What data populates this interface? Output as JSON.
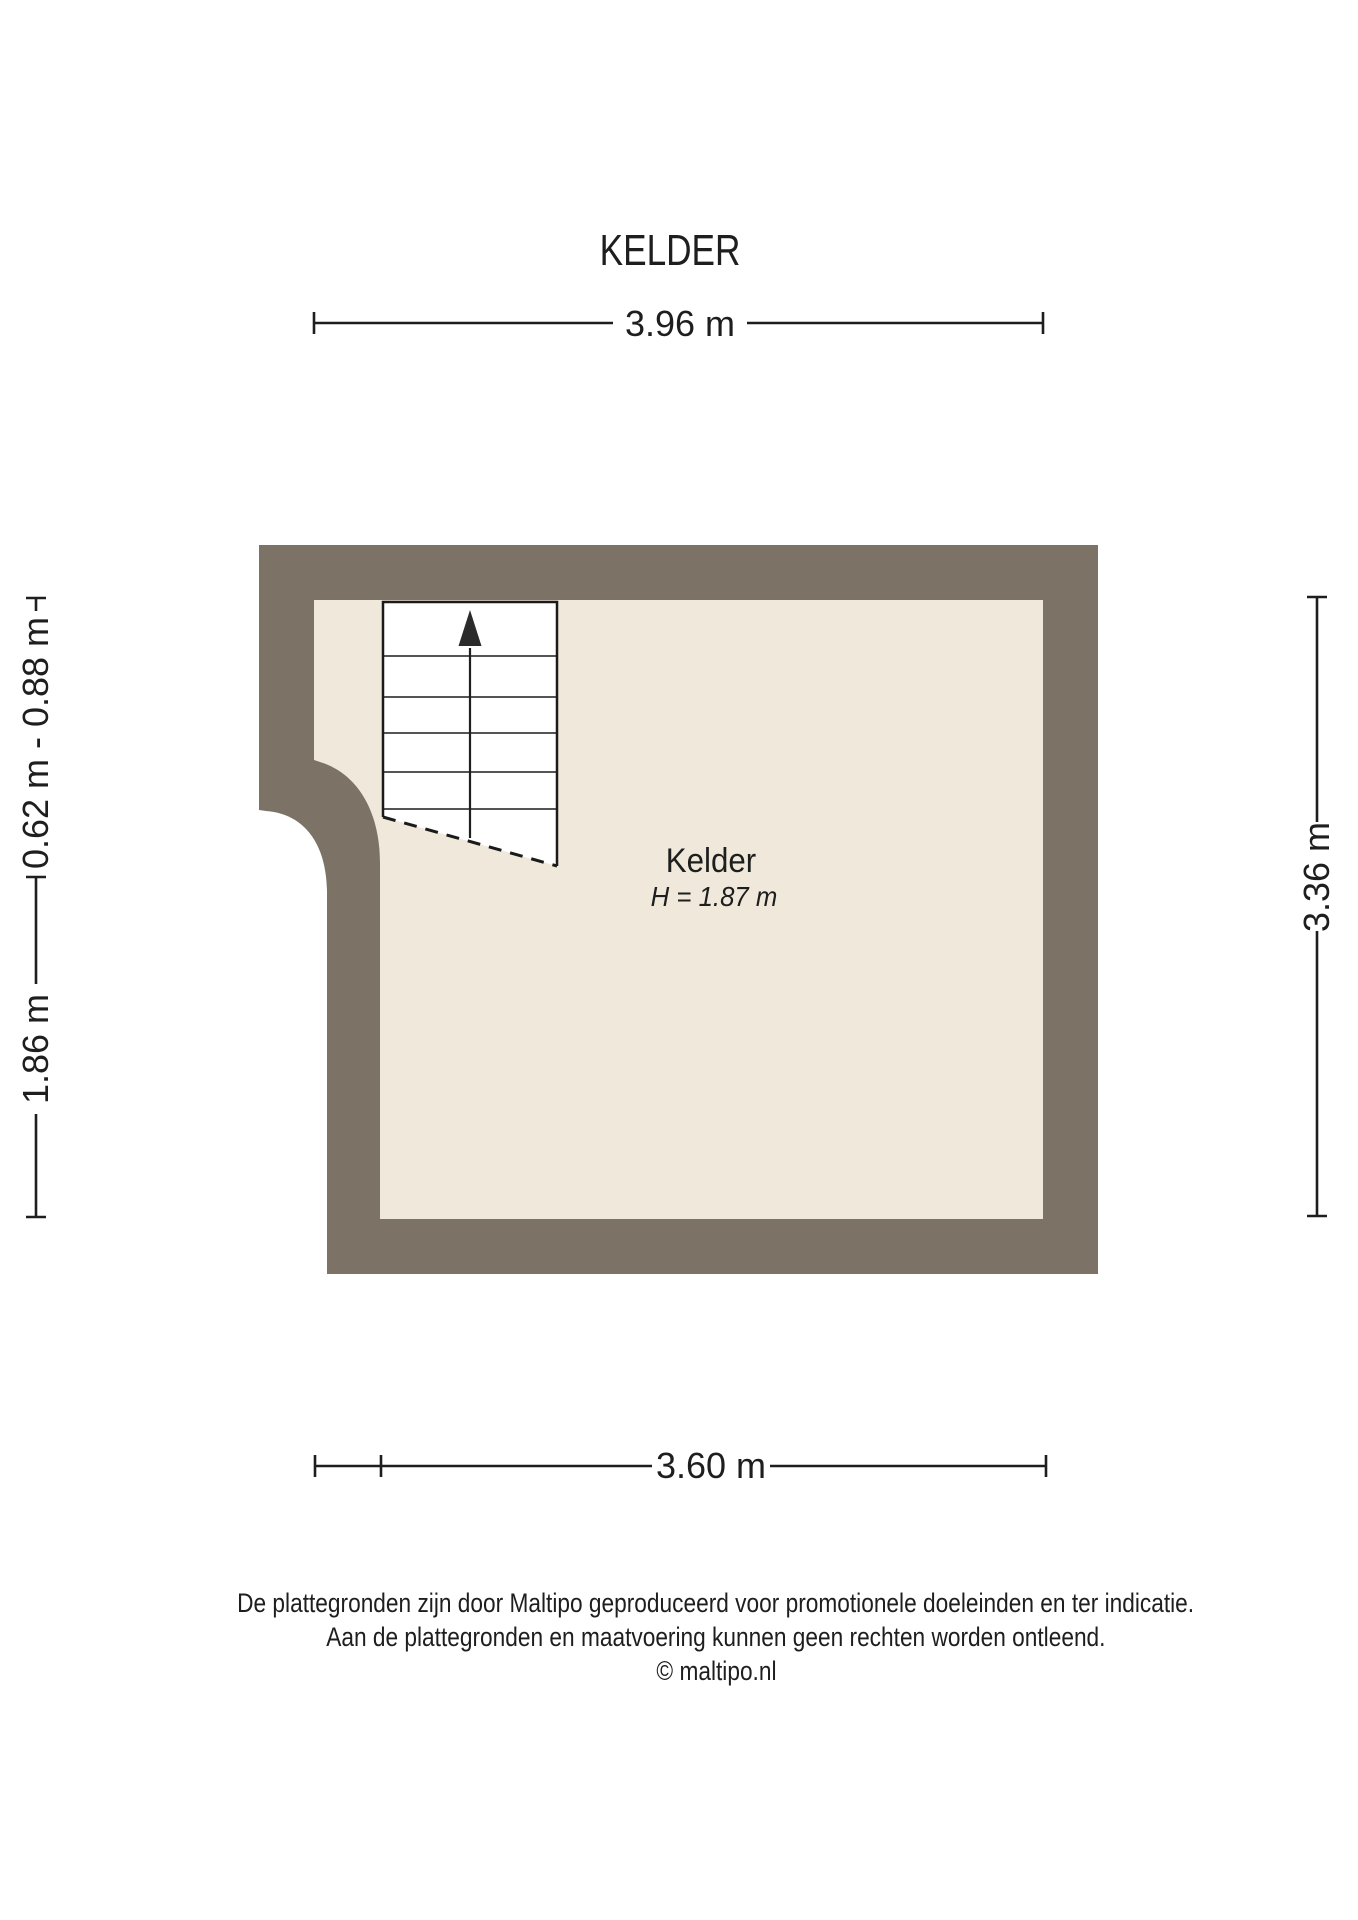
{
  "title": "KELDER",
  "room": {
    "name": "Kelder",
    "height": "H = 1.87 m"
  },
  "dimensions": {
    "top": "3.96 m",
    "left_upper": "0.62 m - 0.88 m",
    "left_lower": "1.86 m",
    "right": "3.36 m",
    "bottom": "3.60 m"
  },
  "footer": {
    "line1": "De plattegronden zijn door Maltipo geproduceerd voor promotionele doeleinden en ter indicatie.",
    "line2": "Aan de plattegronden en maatvoering kunnen geen rechten worden ontleend.",
    "line3": "© maltipo.nl"
  },
  "colors": {
    "wall": "#7C7266",
    "floor": "#EFE8DB",
    "stairs_fill": "#FFFFFF",
    "line": "#1E1E1E"
  }
}
